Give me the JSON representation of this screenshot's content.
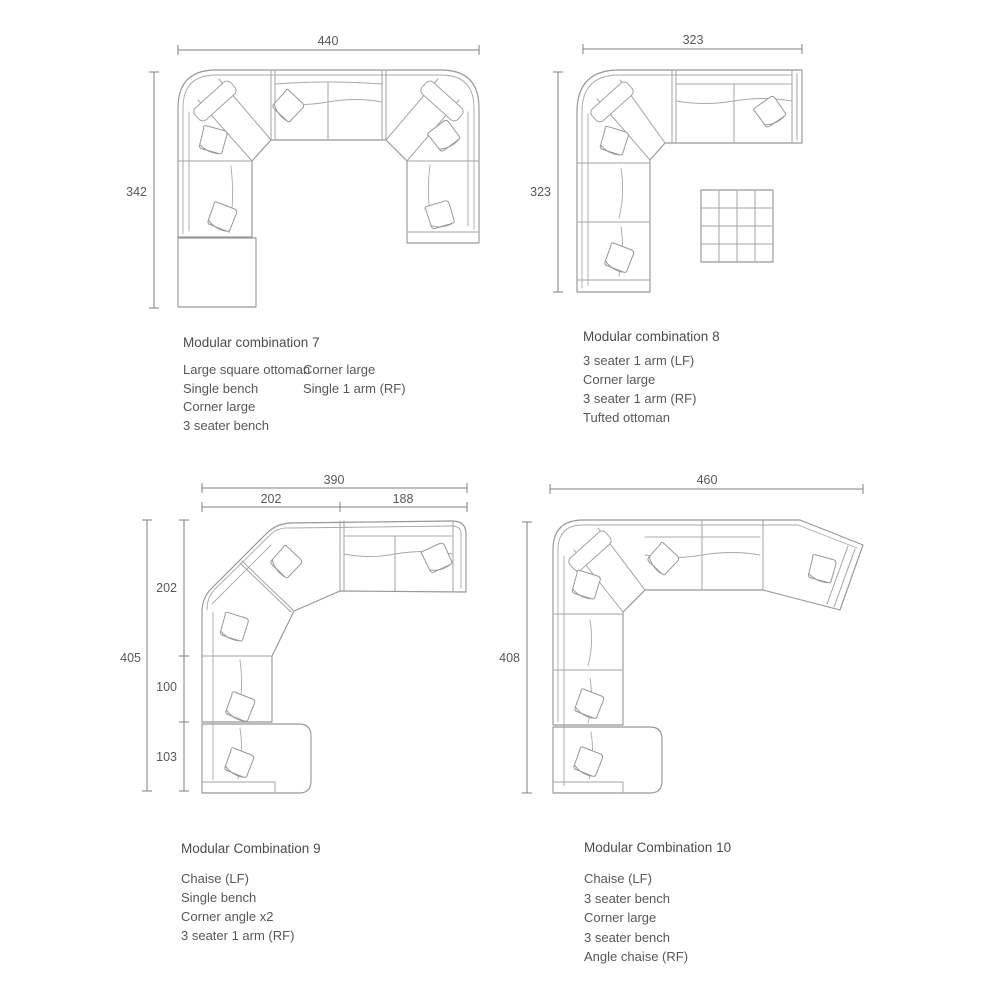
{
  "page": {
    "background_color": "#ffffff",
    "sofa_line_color": "#a3a3a6",
    "dimension_line_color": "#7f7f82",
    "text_color": "#58585b"
  },
  "combos": [
    {
      "id": "combo-7",
      "title": "Modular combination 7",
      "dims": {
        "width": "440",
        "height": "342"
      },
      "parts_col1": [
        "Large square ottoman",
        "Single bench",
        "Corner large",
        "3 seater bench"
      ],
      "parts_col2": [
        "Corner large",
        "Single 1 arm (RF)"
      ]
    },
    {
      "id": "combo-8",
      "title": "Modular combination 8",
      "dims": {
        "width": "323",
        "height": "323"
      },
      "parts": [
        "3 seater 1 arm (LF)",
        "Corner large",
        "3 seater 1 arm (RF)",
        "Tufted ottoman"
      ]
    },
    {
      "id": "combo-9",
      "title": "Modular Combination 9",
      "dims": {
        "width": "390",
        "height": "405",
        "width_left": "202",
        "width_right": "188",
        "segment_top": "202",
        "segment_middle": "100",
        "segment_bottom": "103"
      },
      "parts": [
        "Chaise (LF)",
        "Single bench",
        "Corner angle x2",
        "3 seater 1 arm (RF)"
      ]
    },
    {
      "id": "combo-10",
      "title": "Modular Combination 10",
      "dims": {
        "width": "460",
        "height": "408"
      },
      "parts": [
        "Chaise (LF)",
        "3 seater bench",
        "Corner large",
        "3 seater bench",
        "Angle chaise (RF)"
      ]
    }
  ]
}
